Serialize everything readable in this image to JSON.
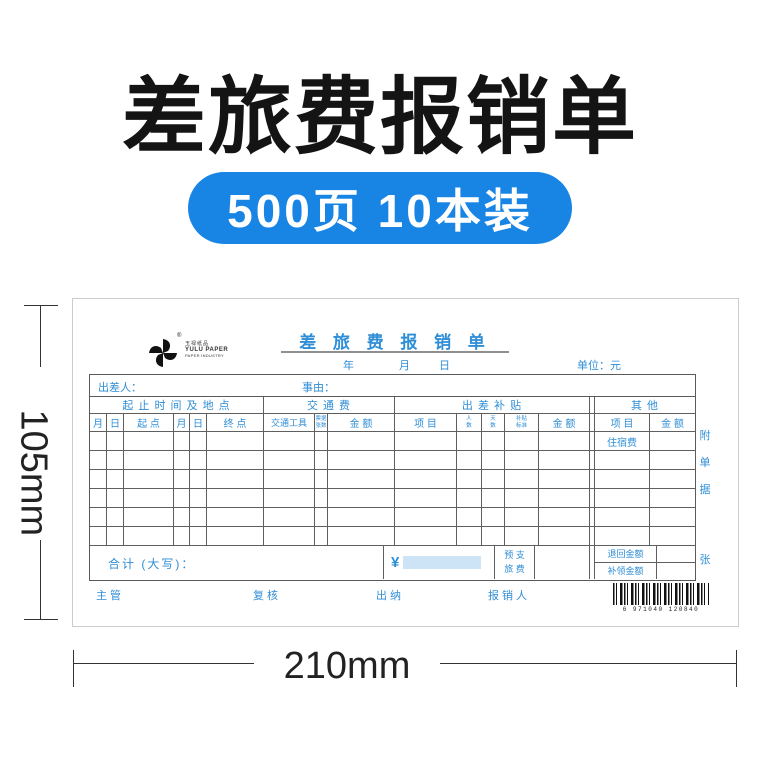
{
  "page": {
    "title": "差旅费报销单",
    "badge": "500页 10本装"
  },
  "dims": {
    "height": "105mm",
    "width": "210mm"
  },
  "colors": {
    "badge_blue": "#1884e4",
    "form_blue": "#2f8ed6",
    "strip_blue": "#cde4f6"
  },
  "brand": {
    "cn": "玉禄纸品",
    "en": "YULU PAPER",
    "sub": "PAPER INDUSTRY",
    "reg": "®"
  },
  "form": {
    "title": "差 旅 费 报 销 单",
    "date": {
      "year": "年",
      "month": "月",
      "day": "日"
    },
    "unit": "单位：元",
    "traveler": "出差人：",
    "reason": "事由：",
    "groups": {
      "time_place": "起 止 时 间 及 地 点",
      "transport": "交  通  费",
      "allowance": "出  差  补  贴",
      "other": "其    他"
    },
    "cols": {
      "month": "月",
      "day": "日",
      "start": "起 点",
      "month2": "月",
      "day2": "日",
      "end": "终 点",
      "vehicle": "交通工具",
      "tickets1": "票据",
      "tickets2": "张数",
      "amount": "金   额",
      "item": "项   目",
      "people1": "人",
      "people2": "数",
      "days1": "天",
      "days2": "数",
      "std1": "补贴",
      "std2": "标准",
      "amount2": "金   额",
      "item2": "项 目",
      "amount3": "金 额"
    },
    "lodging": "住宿费",
    "attach": {
      "a": "附",
      "b": "单",
      "c": "据",
      "sheets": "张"
    },
    "total": "合计 (大写)：",
    "yen": "¥",
    "advance1": "预 支",
    "advance2": "旅 费",
    "refund": "退回金额",
    "supplement": "补领金额",
    "signatures": [
      "主管",
      "复核",
      "出纳",
      "报销人"
    ],
    "barcode": "6 971040 120840"
  }
}
